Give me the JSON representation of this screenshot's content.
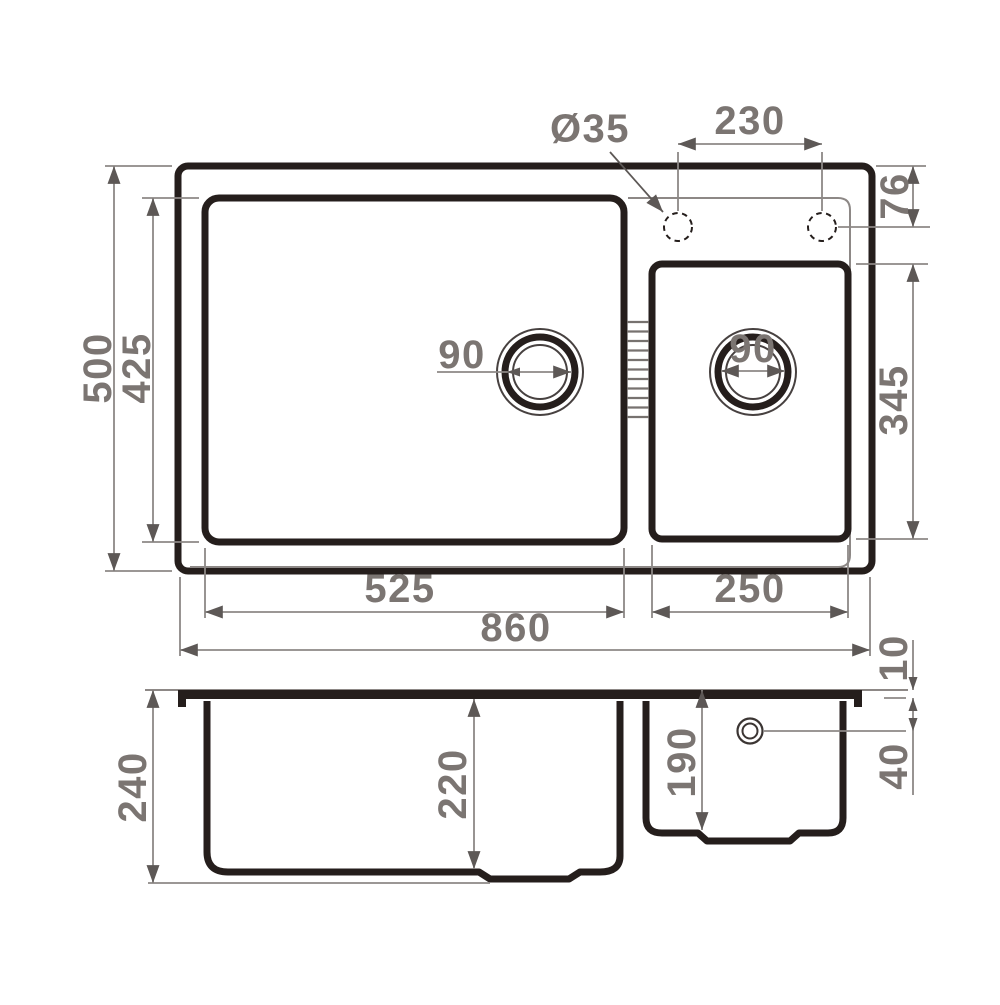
{
  "drawing": {
    "type": "kitchen-sink technical drawing, top view and section view",
    "colors": {
      "outline_dark": "#251e1c",
      "thin_line": "#8d8886",
      "arrow": "#5d5856",
      "text": "#7b7572",
      "background": "#ffffff"
    },
    "top_view": {
      "overall_width": "860",
      "overall_depth": "500",
      "main_bowl_width": "525",
      "main_bowl_depth": "425",
      "right_bowl_width": "250",
      "right_bowl_depth": "345",
      "faucet_hole_diameter": "Ø35",
      "faucet_hole_spacing": "230",
      "faucet_center_offset": "76",
      "main_drain_diameter": "90",
      "right_drain_diameter": "90"
    },
    "side_view": {
      "overall_height": "240",
      "main_bowl_inner_depth": "220",
      "right_bowl_inner_depth": "190",
      "rim_height": "10",
      "overflow_offset": "40"
    }
  }
}
